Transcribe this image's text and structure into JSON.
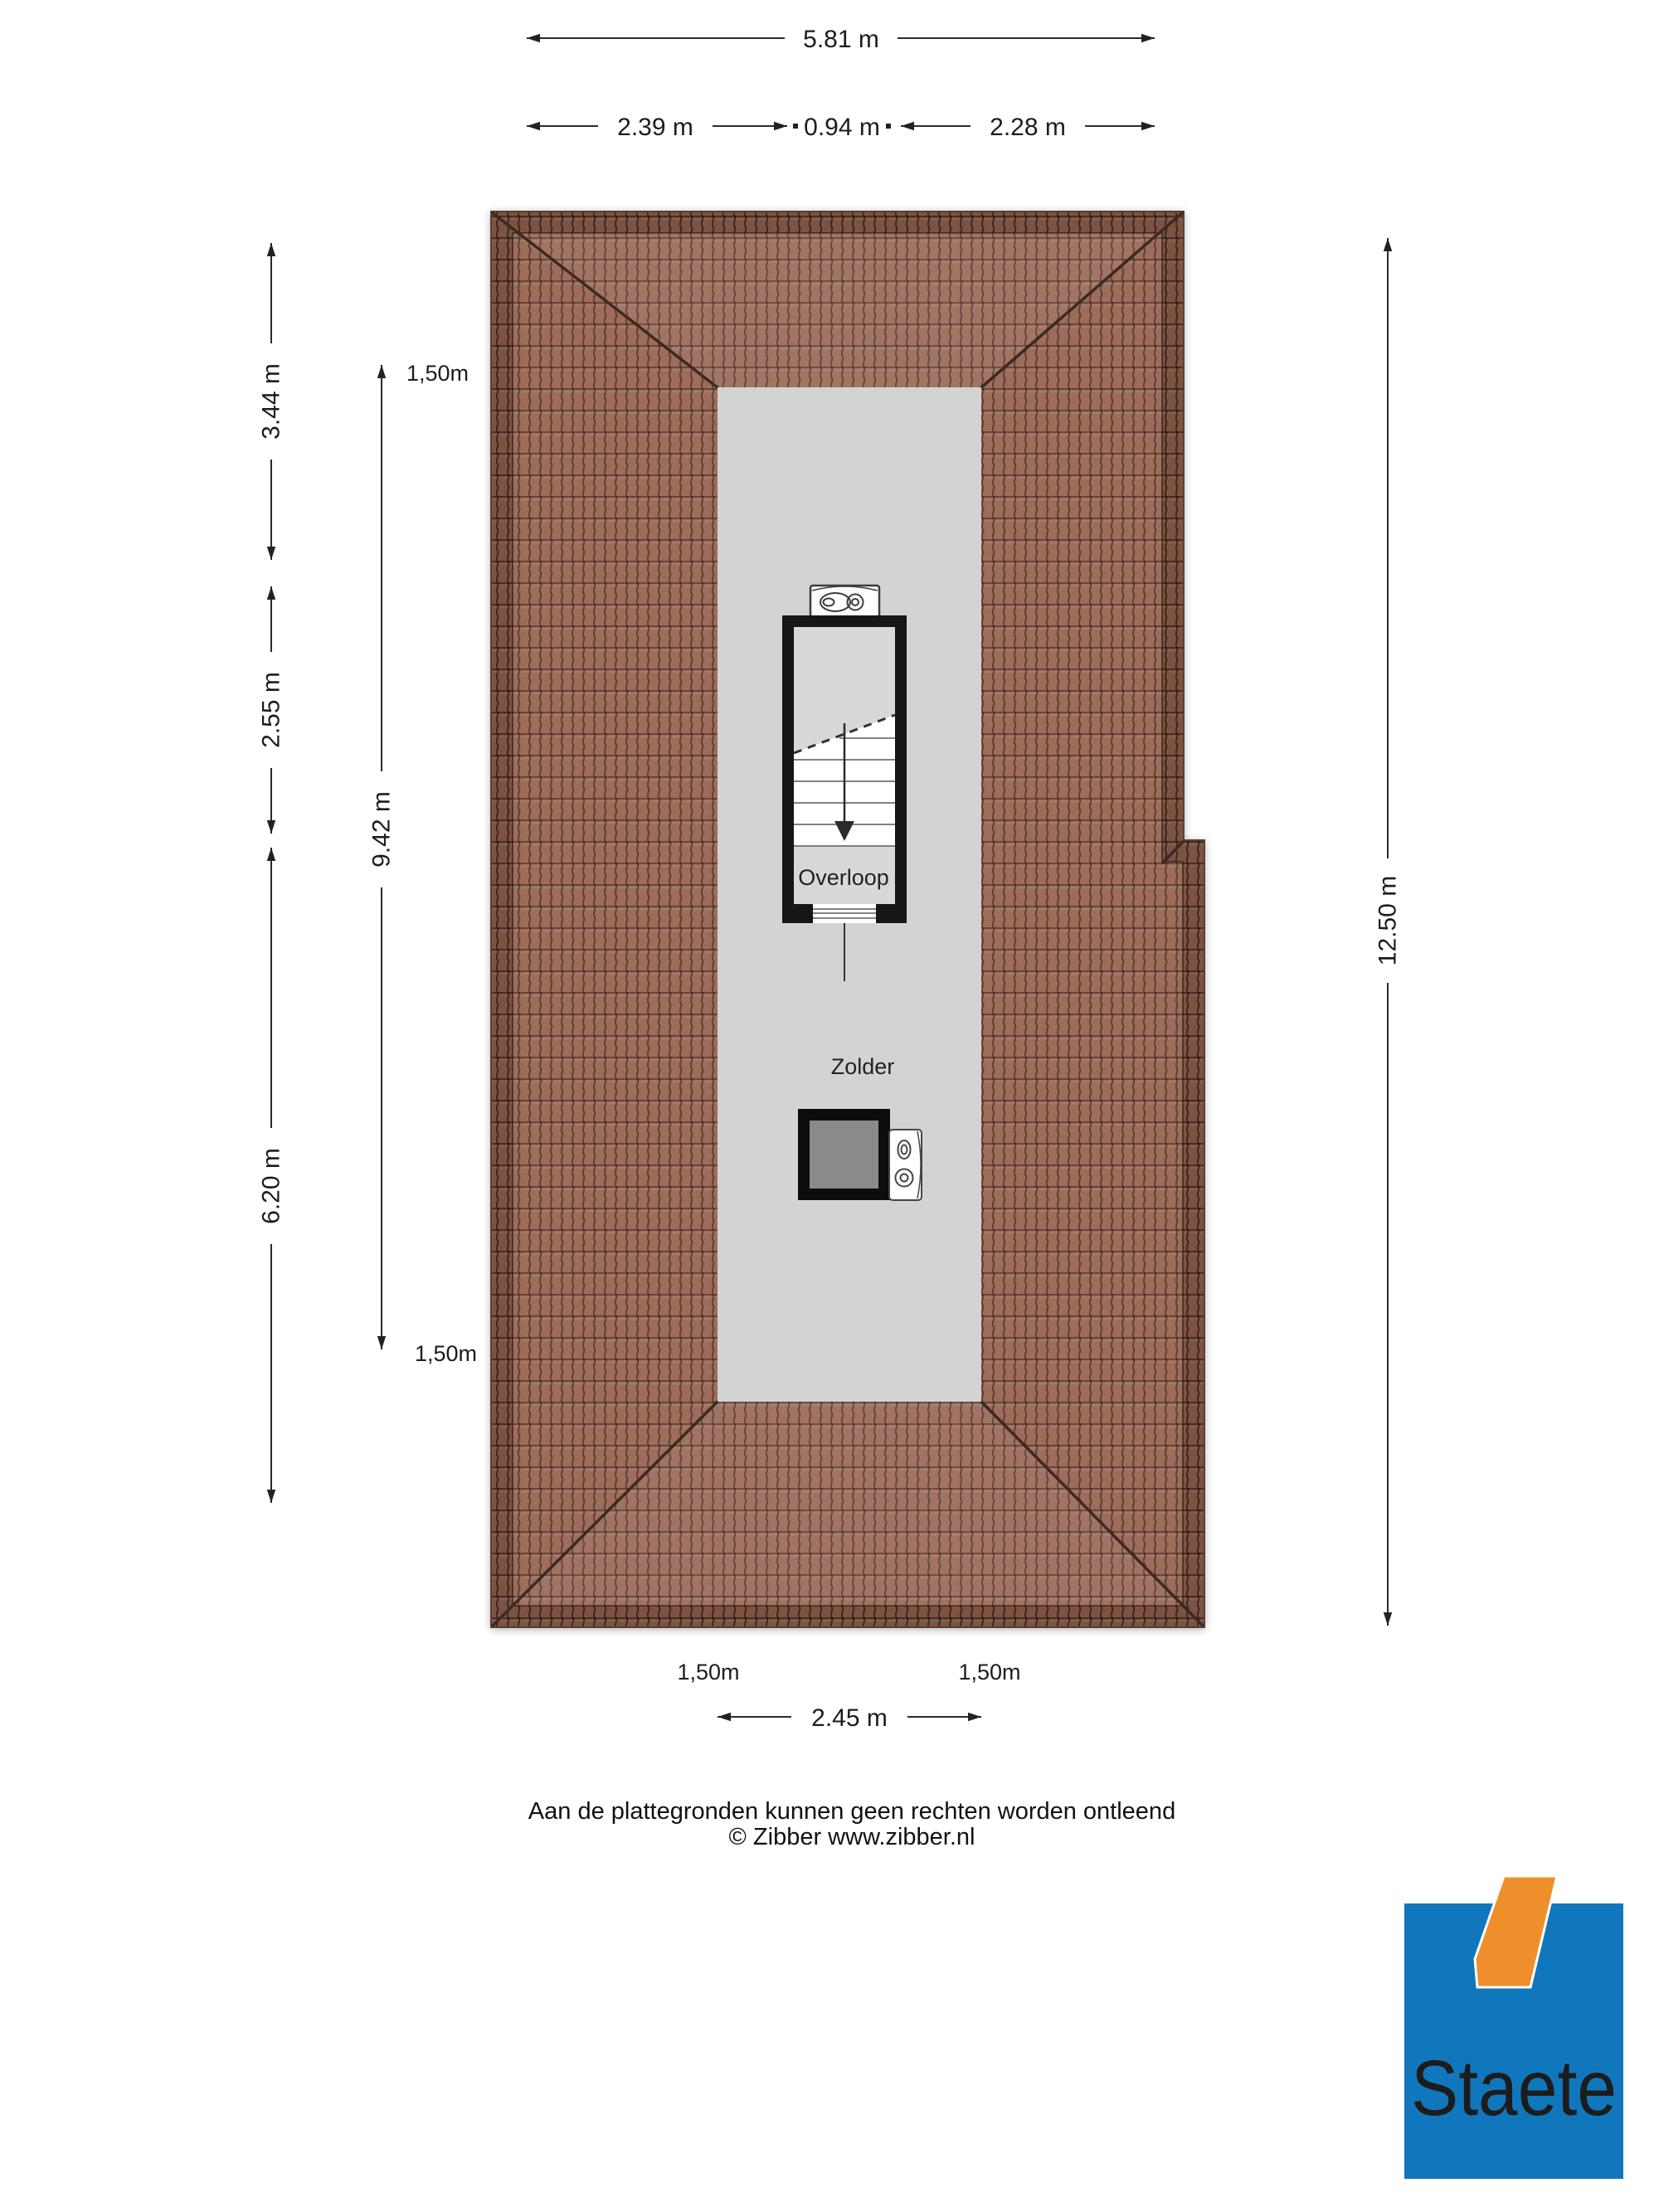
{
  "dimensions": {
    "top_total": "5.81 m",
    "top_seg1": "2.39 m",
    "top_seg2": "0.94 m",
    "top_seg3": "2.28 m",
    "left_seg1": "3.44 m",
    "left_seg2": "2.55 m",
    "left_seg3": "6.20 m",
    "inner_vertical": "9.42 m",
    "right_total": "12.50 m",
    "bottom_width": "2.45 m",
    "headroom_label": "1,50m"
  },
  "rooms": {
    "overloop": "Overloop",
    "zolder": "Zolder"
  },
  "footer": {
    "line1": "Aan de plattegronden kunnen geen rechten worden ontleend",
    "line2": "© Zibber www.zibber.nl"
  },
  "logo": {
    "text": "Staete",
    "blue": "#1177bd",
    "orange": "#ef8f2c"
  },
  "colors": {
    "roof_tile": "#9d6c5a",
    "roof_edge_band": "#7b5342",
    "ridge_line": "#3a2a21",
    "interior_gray": "#d3d3d3",
    "stair_wall": "#141414",
    "chimney_fill": "#8a8a8a"
  }
}
